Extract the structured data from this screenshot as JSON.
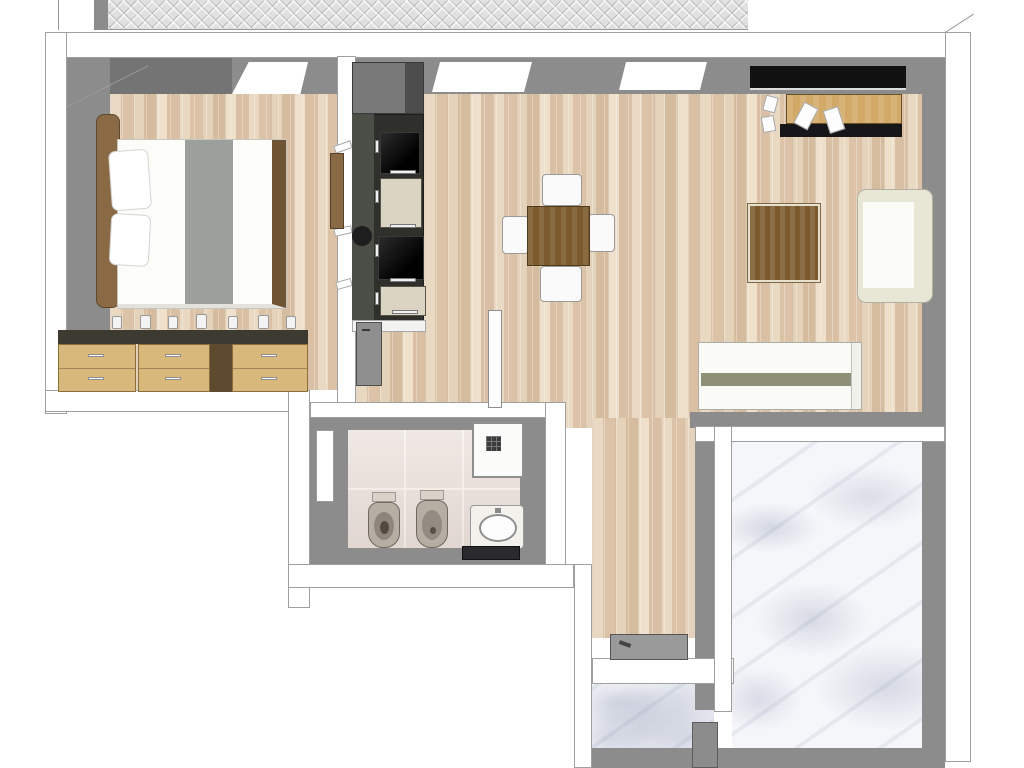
{
  "meta": {
    "scene": "3D top-down rendering of an apartment floor plan",
    "view": "dollhouse top view, no text labels"
  },
  "palette": {
    "wall_white": "#ffffff",
    "outline_grey": "#9f9f9f",
    "wall_grey": "#8c8c8c",
    "wall_grey_dark": "#747474",
    "herringbone_base": "#e0e0e0",
    "wood_base": "#e2ccb4",
    "tile_base": "#eadfd9",
    "marble_base": "#f5f6fa",
    "kitchen_charcoal": "#2f2f2b",
    "kitchen_grey": "#787878",
    "appliance_black": "#111111",
    "cabinet_cream": "#dbd4c2",
    "dresser_tan": "#d9b87c",
    "dresser_dark": "#5e4a2e",
    "dresser_top": "#3d3b31",
    "table_brown": "#7c5a2d",
    "headboard_brown": "#8a6a45",
    "bed_frame_brown": "#6f5433",
    "runner_grey": "#9ba09d",
    "sofa_cream": "#e8e6d5",
    "daybed_stripe": "#8e8f77",
    "ceramic_grey": "#b6ada3",
    "door_grey": "#8f8f8f",
    "counter_dark": "#2a2a2e",
    "desk_tan": "#d2a967",
    "desk_front": "#17171a"
  },
  "rooms": {
    "bedroom": {
      "label": "Bedroom",
      "floor": "wood planks",
      "items": [
        "double bed",
        "grey bed runner",
        "two pillows",
        "wood headboard",
        "three chests of drawers",
        "bottles on dressers",
        "window"
      ]
    },
    "kitchen": {
      "label": "Kitchen",
      "floor": "wood planks",
      "items": [
        "tall dark cabinet run",
        "oven",
        "cooktop",
        "round sink",
        "cream drawer fronts",
        "cutting board"
      ]
    },
    "living": {
      "label": "Living / dining room",
      "floor": "wood planks",
      "items": [
        "square dining table",
        "four white chairs",
        "desk with dark front",
        "two desk chairs",
        "coffee table",
        "cream corner sofa",
        "daybed against terrace wall"
      ]
    },
    "bathroom": {
      "label": "Bathroom",
      "floor": "ceramic tiles",
      "items": [
        "toilet",
        "bidet",
        "washbasin on dark counter",
        "shower tray",
        "side window"
      ]
    },
    "hallway": {
      "label": "Hallway",
      "floor": "wood planks",
      "items": [
        "entrance door mat"
      ]
    },
    "corridor": {
      "label": "Corridor",
      "floor": "wood planks",
      "items": [
        "grey wall door",
        "white open door"
      ]
    },
    "terrace": {
      "label": "Terrace",
      "floor": "marble"
    },
    "landing": {
      "label": "Entrance landing",
      "floor": "marble"
    },
    "upper_strip": {
      "label": "Herringbone paving strip"
    }
  },
  "windows": {
    "top_wall_white_windows": 3,
    "dark_glazed_window": 1,
    "bathroom_window": 1
  }
}
